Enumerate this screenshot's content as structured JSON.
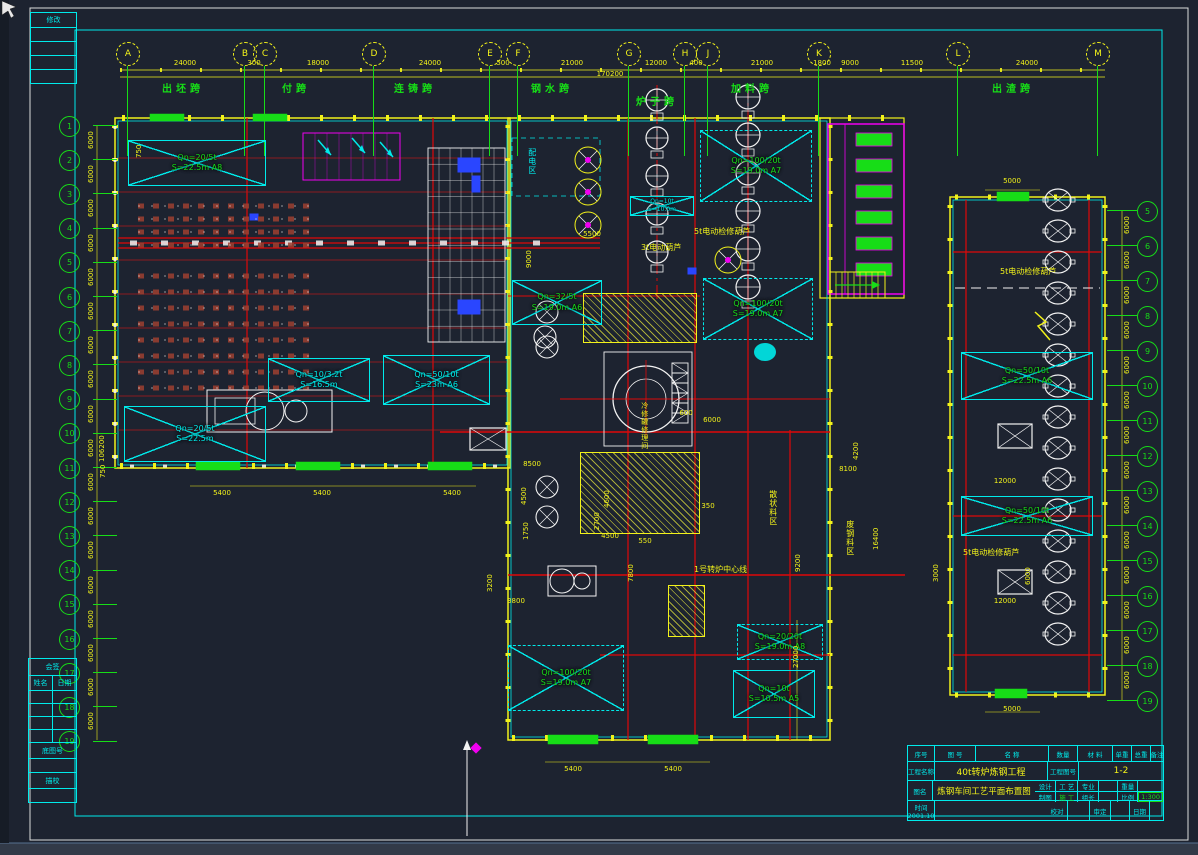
{
  "app": {
    "type": "cad-drawing",
    "sheet": "steel-plant plan"
  },
  "colors": {
    "background": "#1d2330",
    "yellow": "#f2f21a",
    "green": "#17dd17",
    "cyan": "#00eaea",
    "red": "#e00808",
    "magenta": "#f000f0",
    "white": "#f2f2f2",
    "blue": "#2a46ff",
    "brown": "#9e4030"
  },
  "axis_top": {
    "bubbles": [
      {
        "l": "A",
        "x": 127
      },
      {
        "l": "B",
        "x": 244
      },
      {
        "l": "C",
        "x": 264
      },
      {
        "l": "D",
        "x": 373
      },
      {
        "l": "E",
        "x": 489
      },
      {
        "l": "F",
        "x": 517
      },
      {
        "l": "G",
        "x": 628
      },
      {
        "l": "H",
        "x": 684
      },
      {
        "l": "J",
        "x": 707
      },
      {
        "l": "K",
        "x": 818
      },
      {
        "l": "L",
        "x": 957
      },
      {
        "l": "M",
        "x": 1097
      }
    ],
    "dims": [
      {
        "t": "24000",
        "x": 185
      },
      {
        "t": "300",
        "x": 254
      },
      {
        "t": "18000",
        "x": 318
      },
      {
        "t": "24000",
        "x": 430
      },
      {
        "t": "500",
        "x": 503
      },
      {
        "t": "21000",
        "x": 572
      },
      {
        "t": "12000",
        "x": 656
      },
      {
        "t": "400",
        "x": 696
      },
      {
        "t": "21000",
        "x": 762
      },
      {
        "t": "1800",
        "x": 822
      },
      {
        "t": "9000",
        "x": 850
      },
      {
        "t": "11500",
        "x": 912
      },
      {
        "t": "24000",
        "x": 1027
      }
    ],
    "total": "170200",
    "spans": [
      {
        "t": "出坯跨",
        "x": 183
      },
      {
        "t": "付跨",
        "x": 296
      },
      {
        "t": "连铸跨",
        "x": 415
      },
      {
        "t": "钢水跨",
        "x": 552
      },
      {
        "t": "炉子跨",
        "x": 657,
        "y": 97
      },
      {
        "t": "加料跨",
        "x": 752
      },
      {
        "t": "出渣跨",
        "x": 1013
      }
    ]
  },
  "axis_left": {
    "bubbles": [
      "1",
      "2",
      "3",
      "4",
      "5",
      "6",
      "7",
      "8",
      "9",
      "10",
      "11",
      "12",
      "13",
      "14",
      "15",
      "16",
      "17",
      "18",
      "19"
    ],
    "spacing_dim": "6000",
    "total": "106200"
  },
  "axis_right": {
    "bubbles": [
      "5",
      "6",
      "7",
      "8",
      "9",
      "10",
      "11",
      "12",
      "13",
      "14",
      "15",
      "16",
      "17",
      "18",
      "19"
    ],
    "spacing_dim": "6000"
  },
  "cranes": [
    {
      "l1": "Qn=20/5t",
      "l2": "S=22.5m A8",
      "x": 128,
      "y": 140,
      "w": 138,
      "h": 46,
      "style": "green"
    },
    {
      "l1": "Qn=10/3.2t",
      "l2": "S=16.5m",
      "x": 268,
      "y": 358,
      "w": 102,
      "h": 44,
      "style": "cyan"
    },
    {
      "l1": "Qn=50/10t",
      "l2": "S=23m A6",
      "x": 383,
      "y": 355,
      "w": 107,
      "h": 50,
      "style": "cyan"
    },
    {
      "l1": "Qn=20/5t",
      "l2": "S=22.5m",
      "x": 124,
      "y": 406,
      "w": 142,
      "h": 56,
      "style": "cyan"
    },
    {
      "l1": "Qn=32/5t",
      "l2": "S=19.0m A6",
      "x": 512,
      "y": 280,
      "w": 90,
      "h": 45,
      "style": "green"
    },
    {
      "l1": "Qn=10t",
      "l2": "S=10.0m",
      "x": 630,
      "y": 196,
      "w": 64,
      "h": 20,
      "style": "cyan",
      "small": true
    },
    {
      "l1": "Qn=100/20t",
      "l2": "S=19.0m A7",
      "x": 700,
      "y": 130,
      "w": 112,
      "h": 72,
      "style": "green",
      "dashed": true
    },
    {
      "l1": "Qn=100/20t",
      "l2": "S=19.0m A7",
      "x": 703,
      "y": 278,
      "w": 110,
      "h": 62,
      "style": "green",
      "dashed": true
    },
    {
      "l1": "Qn=100/20t",
      "l2": "S=19.0m A7",
      "x": 508,
      "y": 645,
      "w": 116,
      "h": 66,
      "style": "green",
      "dashed": true
    },
    {
      "l1": "Qn=20/20t",
      "l2": "S=19.0m A8",
      "x": 737,
      "y": 624,
      "w": 86,
      "h": 36,
      "style": "green",
      "dashed": true
    },
    {
      "l1": "Qn=10t",
      "l2": "S=10.5m A5",
      "x": 733,
      "y": 670,
      "w": 82,
      "h": 48,
      "style": "green"
    },
    {
      "l1": "Qn=50/10t",
      "l2": "S=22.5m A6",
      "x": 961,
      "y": 352,
      "w": 132,
      "h": 48,
      "style": "green"
    },
    {
      "l1": "Qn=50/10t",
      "l2": "S=22.5m A6",
      "x": 961,
      "y": 496,
      "w": 132,
      "h": 40,
      "style": "green"
    }
  ],
  "labels": [
    {
      "t": "5t电动检修葫芦",
      "x": 694,
      "y": 228,
      "n": "hoist-note",
      "c": "#f2f21a",
      "fs": 8
    },
    {
      "t": "3t电动葫芦",
      "x": 641,
      "y": 244,
      "n": "hoist-note",
      "c": "#f2f21a",
      "fs": 8
    },
    {
      "t": "5t电动检修葫芦",
      "x": 1000,
      "y": 268,
      "n": "hoist-note",
      "c": "#f2f21a",
      "fs": 8
    },
    {
      "t": "5t电动检修葫芦",
      "x": 963,
      "y": 549,
      "n": "hoist-note",
      "c": "#f2f21a",
      "fs": 8
    },
    {
      "t": "1号转炉中心线",
      "x": 694,
      "y": 566,
      "n": "centerline-label",
      "c": "#f2f21a",
      "fs": 8
    },
    {
      "t": "配电区",
      "x": 527,
      "y": 148,
      "n": "zone-label",
      "c": "#00eaea",
      "v": true,
      "fs": 8
    },
    {
      "t": "冷修罐修理间",
      "x": 640,
      "y": 402,
      "n": "zone-label",
      "c": "#f2f21a",
      "v": true,
      "fs": 7
    },
    {
      "t": "散状料区",
      "x": 768,
      "y": 490,
      "n": "zone-label",
      "c": "#f2f21a",
      "v": true,
      "fs": 8
    },
    {
      "t": "废钢料区",
      "x": 845,
      "y": 520,
      "n": "zone-label",
      "c": "#f2f21a",
      "v": true,
      "fs": 8
    },
    {
      "t": "5400",
      "x": 222,
      "y": 490,
      "n": "dim-label",
      "ctr": true
    },
    {
      "t": "5400",
      "x": 322,
      "y": 490,
      "n": "dim-label",
      "ctr": true
    },
    {
      "t": "5400",
      "x": 452,
      "y": 490,
      "n": "dim-label",
      "ctr": true
    },
    {
      "t": "5400",
      "x": 573,
      "y": 766,
      "n": "dim-label",
      "ctr": true
    },
    {
      "t": "5400",
      "x": 673,
      "y": 766,
      "n": "dim-label",
      "ctr": true
    },
    {
      "t": "5000",
      "x": 1012,
      "y": 178,
      "n": "dim-label",
      "ctr": true
    },
    {
      "t": "5000",
      "x": 1012,
      "y": 706,
      "n": "dim-label",
      "ctr": true
    },
    {
      "t": "5500",
      "x": 592,
      "y": 231,
      "n": "dim-label",
      "ctr": true
    },
    {
      "t": "8500",
      "x": 532,
      "y": 461,
      "n": "dim-label",
      "ctr": true
    },
    {
      "t": "4500",
      "x": 521,
      "y": 505,
      "n": "dim-label",
      "r": -90
    },
    {
      "t": "1750",
      "x": 523,
      "y": 540,
      "n": "dim-label",
      "r": -90
    },
    {
      "t": "4600",
      "x": 604,
      "y": 508,
      "n": "dim-label",
      "r": -90
    },
    {
      "t": "2700",
      "x": 594,
      "y": 530,
      "n": "dim-label",
      "r": -90
    },
    {
      "t": "4500",
      "x": 610,
      "y": 533,
      "n": "dim-label",
      "ctr": true
    },
    {
      "t": "7800",
      "x": 628,
      "y": 582,
      "n": "dim-label",
      "r": -90
    },
    {
      "t": "3800",
      "x": 516,
      "y": 598,
      "n": "dim-label",
      "ctr": true
    },
    {
      "t": "3200",
      "x": 487,
      "y": 592,
      "n": "dim-label",
      "r": -90
    },
    {
      "t": "550",
      "x": 645,
      "y": 538,
      "n": "dim-label",
      "ctr": true
    },
    {
      "t": "350",
      "x": 708,
      "y": 503,
      "n": "dim-label",
      "ctr": true
    },
    {
      "t": "8100",
      "x": 848,
      "y": 466,
      "n": "dim-label",
      "ctr": true
    },
    {
      "t": "4200",
      "x": 853,
      "y": 460,
      "n": "dim-label",
      "r": -90
    },
    {
      "t": "16400",
      "x": 873,
      "y": 550,
      "n": "dim-label",
      "r": -90
    },
    {
      "t": "9200",
      "x": 795,
      "y": 572,
      "n": "dim-label",
      "r": -90
    },
    {
      "t": "3000",
      "x": 933,
      "y": 582,
      "n": "dim-label",
      "r": -90
    },
    {
      "t": "12000",
      "x": 1005,
      "y": 478,
      "n": "dim-label",
      "ctr": true
    },
    {
      "t": "12000",
      "x": 1005,
      "y": 598,
      "n": "dim-label",
      "ctr": true
    },
    {
      "t": "6000",
      "x": 1025,
      "y": 585,
      "n": "dim-label",
      "r": -90
    },
    {
      "t": "600",
      "x": 686,
      "y": 410,
      "n": "dim-label",
      "ctr": true
    },
    {
      "t": "6000",
      "x": 712,
      "y": 417,
      "n": "dim-label",
      "ctr": true
    },
    {
      "t": "27000",
      "x": 793,
      "y": 668,
      "n": "dim-label",
      "r": -90
    },
    {
      "t": "9000",
      "x": 526,
      "y": 268,
      "n": "dim-label",
      "r": -90
    },
    {
      "t": "750",
      "x": 136,
      "y": 158,
      "n": "dim-label",
      "r": -90
    },
    {
      "t": "750",
      "x": 100,
      "y": 478,
      "n": "dim-label",
      "r": -90
    }
  ],
  "frame": {
    "revision": {
      "header": "修改",
      "rows": 4
    },
    "countersign": {
      "header": "会签",
      "col1": "姓名",
      "col2": "日期",
      "base_no": "底图号",
      "trace_check": "描校"
    }
  },
  "title_block": {
    "headers": [
      "序号",
      "图  号",
      "名    称",
      "数量",
      "材 料",
      "单重",
      "总重",
      "备注"
    ],
    "project_label": "工程名称",
    "project_name": "40t转炉炼钢工程",
    "sheet_label": "工程图号",
    "sheet_no": "1-2",
    "drawing_label": "图名",
    "drawing_name": "炼钢车间工艺平面布置图",
    "time_label": "时间",
    "time_value": "2001.10",
    "grid": {
      "design_label": "设计",
      "craft_value": "工 艺",
      "major_label": "专业",
      "weight_label": "重量",
      "draft_label": "制图",
      "construct_value": "施 工",
      "leader_label": "组长",
      "scale_label": "比例",
      "scale_value": "1:300",
      "check_label": "校对",
      "approve_label": "审定",
      "date_label": "日期"
    }
  }
}
